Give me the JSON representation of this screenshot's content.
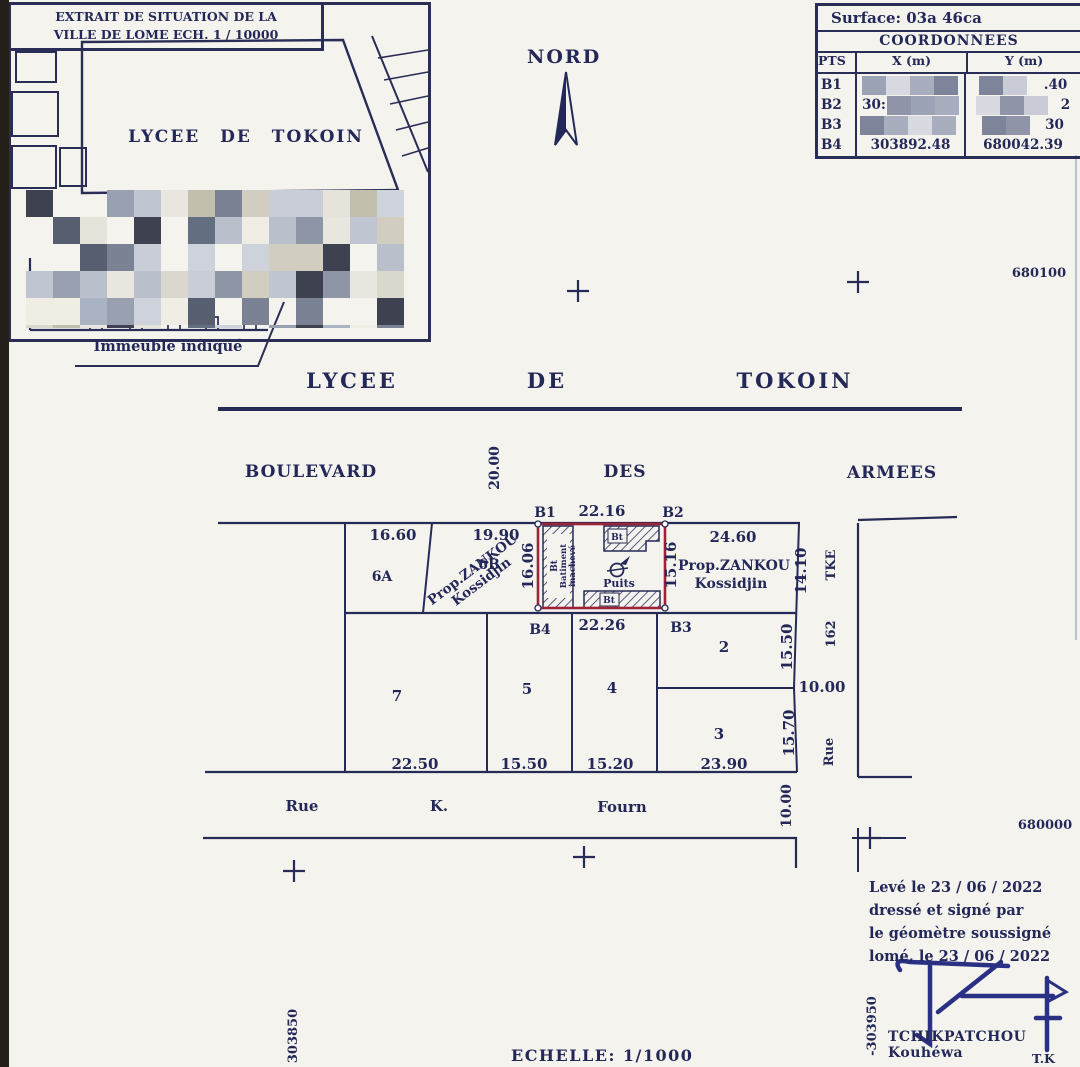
{
  "inset": {
    "title_line1": "EXTRAIT DE SITUATION DE LA",
    "title_line2": "VILLE DE LOME ECH. 1 / 10000",
    "block_label": "LYCEE DE TOKOIN",
    "caption": "Immeuble indiqué"
  },
  "north": {
    "label": "NORD"
  },
  "coordinates_table": {
    "surface": "Surface: 03a 46ca",
    "title": "COORDONNEES",
    "headers": {
      "pts": "PTS",
      "x": "X (m)",
      "y": "Y (m)"
    },
    "rows": [
      {
        "pt": "B1",
        "x": "",
        "y": ".40"
      },
      {
        "pt": "B2",
        "x": "30:",
        "y": "2"
      },
      {
        "pt": "B3",
        "x": "",
        "y": "30"
      },
      {
        "pt": "B4",
        "x": "303892.48",
        "y": "680042.39"
      }
    ]
  },
  "streets": {
    "lycee": {
      "w1": "LYCEE",
      "w2": "DE",
      "w3": "TOKOIN"
    },
    "boulevard": {
      "w1": "BOULEVARD",
      "w2": "DES",
      "w3": "ARMEES",
      "width": "20.00"
    },
    "rue_k_fourn": {
      "w1": "Rue",
      "w2": "K.",
      "w3": "Fourn",
      "width": "10.00"
    },
    "rue_162": {
      "name": "Rue",
      "number": "162",
      "suffix": "TKE",
      "width": "10.00"
    }
  },
  "plot": {
    "corners": {
      "b1": "B1",
      "b2": "B2",
      "b3": "B3",
      "b4": "B4"
    },
    "dims": {
      "top": "22.16",
      "bottom": "22.26",
      "left": "16.06",
      "right": "15.16"
    },
    "building_abbr": "Bt",
    "building_note1": "Batiment",
    "building_note2": "inachevé",
    "well": "Puits"
  },
  "parcels": {
    "p6a": "6A",
    "p6b": "6B",
    "p2": "2",
    "p3": "3",
    "p4": "4",
    "p5": "5",
    "p7": "7",
    "owner_line1": "Prop.ZANKOU",
    "owner_line2": "Kossidjin",
    "dims": {
      "d6a": "16.60",
      "d6b": "19.90",
      "d_right_top": "24.60",
      "d_right_side": "14.10",
      "d2": "15.50",
      "d3_side": "15.70",
      "d3_bottom": "23.90",
      "d7": "22.50",
      "d5": "15.50",
      "d4": "15.20"
    }
  },
  "grid": {
    "y_top": "680100",
    "y_bottom": "680000",
    "x_left": "303850",
    "x_right": "-303950"
  },
  "footer": {
    "line1": "Levé le 23 / 06 / 2022",
    "line2": "dressé et signé par",
    "line3": "le géomètre soussigné",
    "line4": "lomé, le 23 / 06 / 2022",
    "surveyor": "TCHIKPATCHOU Kouhéwa",
    "initials": "T.K",
    "scale": "ECHELLE: 1/1000"
  },
  "colors": {
    "ink": "#232858",
    "plot_red": "#9c2338",
    "paper": "#f4f3ee",
    "scan_edge": "#241f19",
    "redaction_palettes": {
      "inset": [
        "#c9cdd7",
        "#aab3c1",
        "#8e96a5",
        "#dad7cc",
        "#f0ede5",
        "#646e81",
        "#3e4250",
        "#b9c0cc",
        "#e5e3da",
        "#99a1b0",
        "#7a8293",
        "#d1cdc1",
        "#bfc6d2",
        "transparent",
        "transparent",
        "#e8e6de",
        "#565e70",
        "#cdd2db",
        "transparent",
        "#c2bfae"
      ],
      "table": [
        "#b6bac9",
        "#9da3b6",
        "#898fa4",
        "#c9cbd6",
        "#d9dae1",
        "#767b91",
        "#8f94a8",
        "#a9aebf",
        "#c2c4cf",
        "#7e8499"
      ]
    }
  }
}
